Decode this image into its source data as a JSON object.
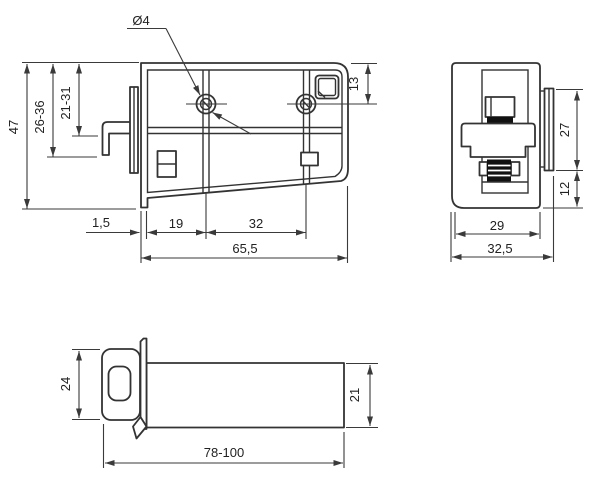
{
  "drawing": {
    "type": "technical-orthographic-drawing",
    "subject": "adjustable cabinet latch with strike hook",
    "colors": {
      "background": "#ffffff",
      "object_line": "#333333",
      "dimension_line": "#3a3a3a",
      "text": "#222222",
      "spring_fill": "#111111"
    },
    "dimensions": {
      "front": {
        "hole_diameter": "Ø4",
        "total_height": "47",
        "hook_reach_max_range": "26-36",
        "hook_reach_min_range": "21-31",
        "hole_center_from_top": "13",
        "panel_gap": "1,5",
        "first_hole_offset": "19",
        "hole_spacing": "32",
        "body_length": "65,5"
      },
      "side": {
        "latch_plate_height": "27",
        "plate_to_bottom": "12",
        "body_depth": "29",
        "overall_depth": "32,5"
      },
      "bottom": {
        "knob_width": "24",
        "housing_width": "21",
        "adjustable_length_range": "78-100"
      }
    }
  }
}
